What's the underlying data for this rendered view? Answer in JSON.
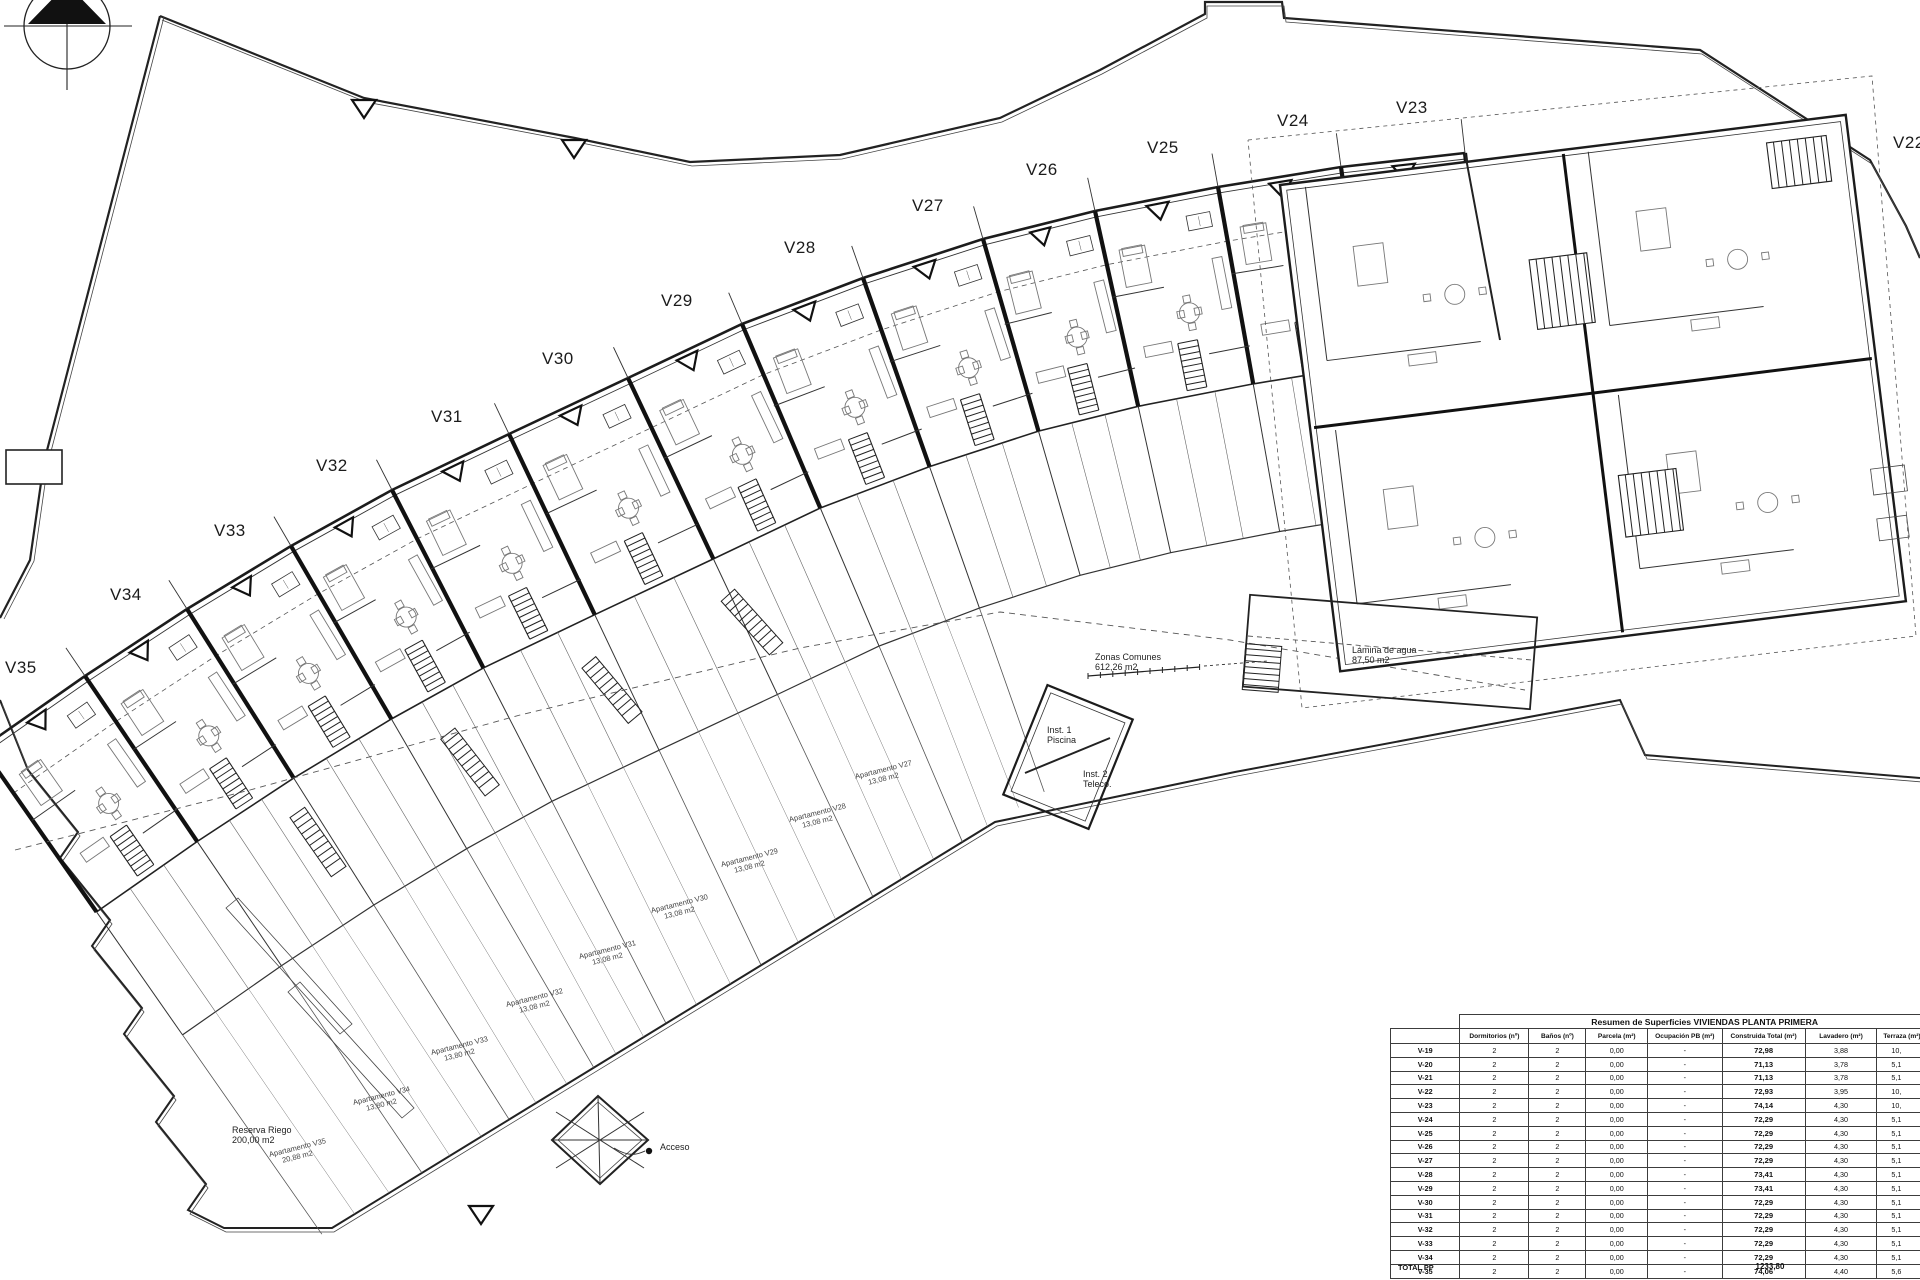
{
  "plan": {
    "unit_labels": [
      {
        "id": "V22",
        "x": 1893,
        "y": 148
      },
      {
        "id": "V23",
        "x": 1396,
        "y": 113
      },
      {
        "id": "V24",
        "x": 1277,
        "y": 126
      },
      {
        "id": "V25",
        "x": 1147,
        "y": 153
      },
      {
        "id": "V26",
        "x": 1026,
        "y": 175
      },
      {
        "id": "V27",
        "x": 912,
        "y": 211
      },
      {
        "id": "V28",
        "x": 784,
        "y": 253
      },
      {
        "id": "V29",
        "x": 661,
        "y": 306
      },
      {
        "id": "V30",
        "x": 542,
        "y": 364
      },
      {
        "id": "V31",
        "x": 431,
        "y": 422
      },
      {
        "id": "V32",
        "x": 316,
        "y": 471
      },
      {
        "id": "V33",
        "x": 214,
        "y": 536
      },
      {
        "id": "V34",
        "x": 110,
        "y": 600
      },
      {
        "id": "V35",
        "x": 5,
        "y": 673
      }
    ],
    "annotations": [
      {
        "id": "zonas-comunes",
        "lines": [
          "Zonas Comunes",
          "612,26 m2"
        ],
        "x": 1095,
        "y": 660
      },
      {
        "id": "lamina-de-agua",
        "lines": [
          "Lámina de agua",
          "87,50 m2"
        ],
        "x": 1352,
        "y": 653
      },
      {
        "id": "inst-1-piscina",
        "lines": [
          "Inst. 1",
          "Piscina"
        ],
        "x": 1047,
        "y": 733
      },
      {
        "id": "inst-2-teleco",
        "lines": [
          "Inst. 2",
          "Teleco."
        ],
        "x": 1083,
        "y": 777
      },
      {
        "id": "acceso",
        "lines": [
          "Acceso"
        ],
        "x": 660,
        "y": 1150
      },
      {
        "id": "reserva-riego",
        "lines": [
          "Reserva Riego",
          "200,00 m2"
        ],
        "x": 232,
        "y": 1133
      }
    ],
    "terrace_labels": [
      {
        "id": "apartamento-v35",
        "lines": [
          "Apartamento V35",
          "20,88 m2"
        ],
        "x": 298,
        "y": 1150
      },
      {
        "id": "apartamento-v34",
        "lines": [
          "Apartamento V34",
          "13,80 m2"
        ],
        "x": 382,
        "y": 1098
      },
      {
        "id": "apartamento-v33",
        "lines": [
          "Apartamento V33",
          "13,80 m2"
        ],
        "x": 460,
        "y": 1048
      },
      {
        "id": "apartamento-v32",
        "lines": [
          "Apartamento V32",
          "13,08 m2"
        ],
        "x": 535,
        "y": 1000
      },
      {
        "id": "apartamento-v31",
        "lines": [
          "Apartamento V31",
          "13,08 m2"
        ],
        "x": 608,
        "y": 952
      },
      {
        "id": "apartamento-v30",
        "lines": [
          "Apartamento V30",
          "13,08 m2"
        ],
        "x": 680,
        "y": 906
      },
      {
        "id": "apartamento-v29",
        "lines": [
          "Apartamento V29",
          "13,08 m2"
        ],
        "x": 750,
        "y": 860
      },
      {
        "id": "apartamento-v28",
        "lines": [
          "Apartamento V28",
          "13,08 m2"
        ],
        "x": 818,
        "y": 815
      },
      {
        "id": "apartamento-v27",
        "lines": [
          "Apartamento V27",
          "13,08 m2"
        ],
        "x": 884,
        "y": 772
      }
    ]
  },
  "table": {
    "title": "Resumen de Superficies VIVIENDAS PLANTA PRIMERA",
    "columns": [
      "",
      "Dormitorios (nº)",
      "Baños (nº)",
      "Parcela (m²)",
      "Ocupación PB (m²)",
      "Construida Total (m²)",
      "Lavadero (m²)",
      "Terraza (m²)"
    ],
    "rows": [
      [
        "V-19",
        "2",
        "2",
        "0,00",
        "-",
        "72,98",
        "3,88",
        "10,"
      ],
      [
        "V-20",
        "2",
        "2",
        "0,00",
        "-",
        "71,13",
        "3,78",
        "5,1"
      ],
      [
        "V-21",
        "2",
        "2",
        "0,00",
        "-",
        "71,13",
        "3,78",
        "5,1"
      ],
      [
        "V-22",
        "2",
        "2",
        "0,00",
        "-",
        "72,93",
        "3,95",
        "10,"
      ],
      [
        "V-23",
        "2",
        "2",
        "0,00",
        "-",
        "74,14",
        "4,30",
        "10,"
      ],
      [
        "V-24",
        "2",
        "2",
        "0,00",
        "-",
        "72,29",
        "4,30",
        "5,1"
      ],
      [
        "V-25",
        "2",
        "2",
        "0,00",
        "-",
        "72,29",
        "4,30",
        "5,1"
      ],
      [
        "V-26",
        "2",
        "2",
        "0,00",
        "-",
        "72,29",
        "4,30",
        "5,1"
      ],
      [
        "V-27",
        "2",
        "2",
        "0,00",
        "-",
        "72,29",
        "4,30",
        "5,1"
      ],
      [
        "V-28",
        "2",
        "2",
        "0,00",
        "-",
        "73,41",
        "4,30",
        "5,1"
      ],
      [
        "V-29",
        "2",
        "2",
        "0,00",
        "-",
        "73,41",
        "4,30",
        "5,1"
      ],
      [
        "V-30",
        "2",
        "2",
        "0,00",
        "-",
        "72,29",
        "4,30",
        "5,1"
      ],
      [
        "V-31",
        "2",
        "2",
        "0,00",
        "-",
        "72,29",
        "4,30",
        "5,1"
      ],
      [
        "V-32",
        "2",
        "2",
        "0,00",
        "-",
        "72,29",
        "4,30",
        "5,1"
      ],
      [
        "V-33",
        "2",
        "2",
        "0,00",
        "-",
        "72,29",
        "4,30",
        "5,1"
      ],
      [
        "V-34",
        "2",
        "2",
        "0,00",
        "-",
        "72,29",
        "4,30",
        "5,1"
      ],
      [
        "V-35",
        "2",
        "2",
        "0,00",
        "-",
        "74,06",
        "4,40",
        "5,6"
      ]
    ],
    "total_label": "TOTAL PP",
    "total_value": "1233,80"
  }
}
